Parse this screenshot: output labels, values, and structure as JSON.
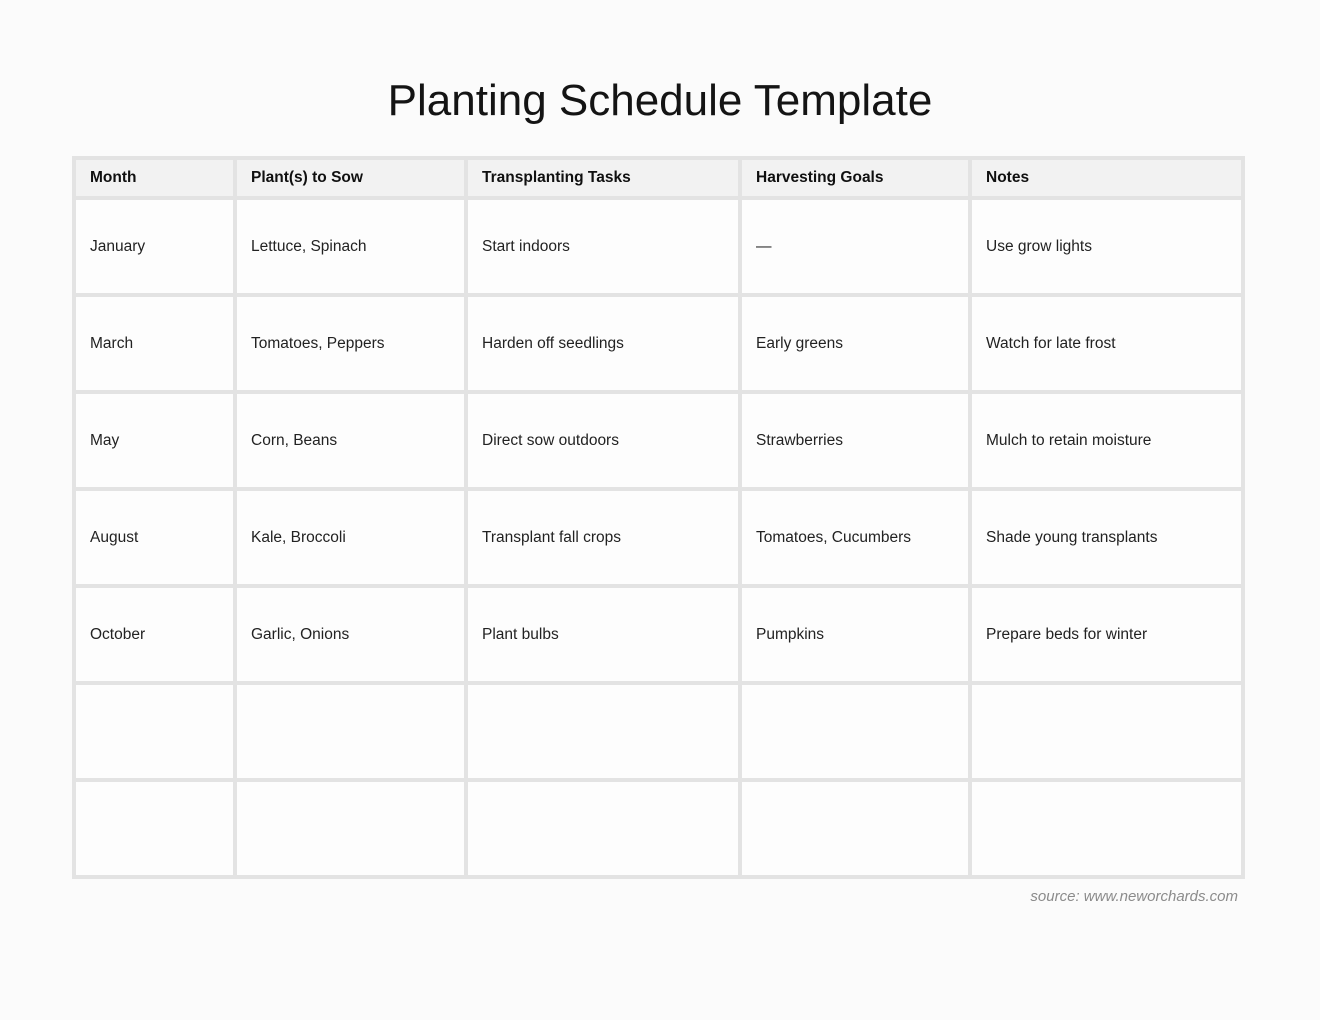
{
  "page": {
    "title": "Planting Schedule Template",
    "source_note": "source: www.neworchards.com"
  },
  "table": {
    "columns": [
      "Month",
      "Plant(s) to Sow",
      "Transplanting Tasks",
      "Harvesting Goals",
      "Notes"
    ],
    "rows": [
      [
        "January",
        "Lettuce, Spinach",
        "Start indoors",
        "—",
        "Use grow lights"
      ],
      [
        "March",
        "Tomatoes, Peppers",
        "Harden off seedlings",
        "Early greens",
        "Watch for late frost"
      ],
      [
        "May",
        "Corn, Beans",
        "Direct sow outdoors",
        "Strawberries",
        "Mulch to retain moisture"
      ],
      [
        "August",
        "Kale, Broccoli",
        "Transplant fall crops",
        "Tomatoes, Cucumbers",
        "Shade young transplants"
      ],
      [
        "October",
        "Garlic, Onions",
        "Plant bulbs",
        "Pumpkins",
        "Prepare beds for winter"
      ],
      [
        "",
        "",
        "",
        "",
        ""
      ],
      [
        "",
        "",
        "",
        "",
        ""
      ]
    ]
  },
  "colors": {
    "page_bg": "#fbfbfb",
    "grid": "#e3e3e3",
    "header_bg": "#f2f2f2",
    "cell_bg": "#fdfdfd",
    "text": "#1e1e1e",
    "source_text": "#8b8b8b"
  }
}
